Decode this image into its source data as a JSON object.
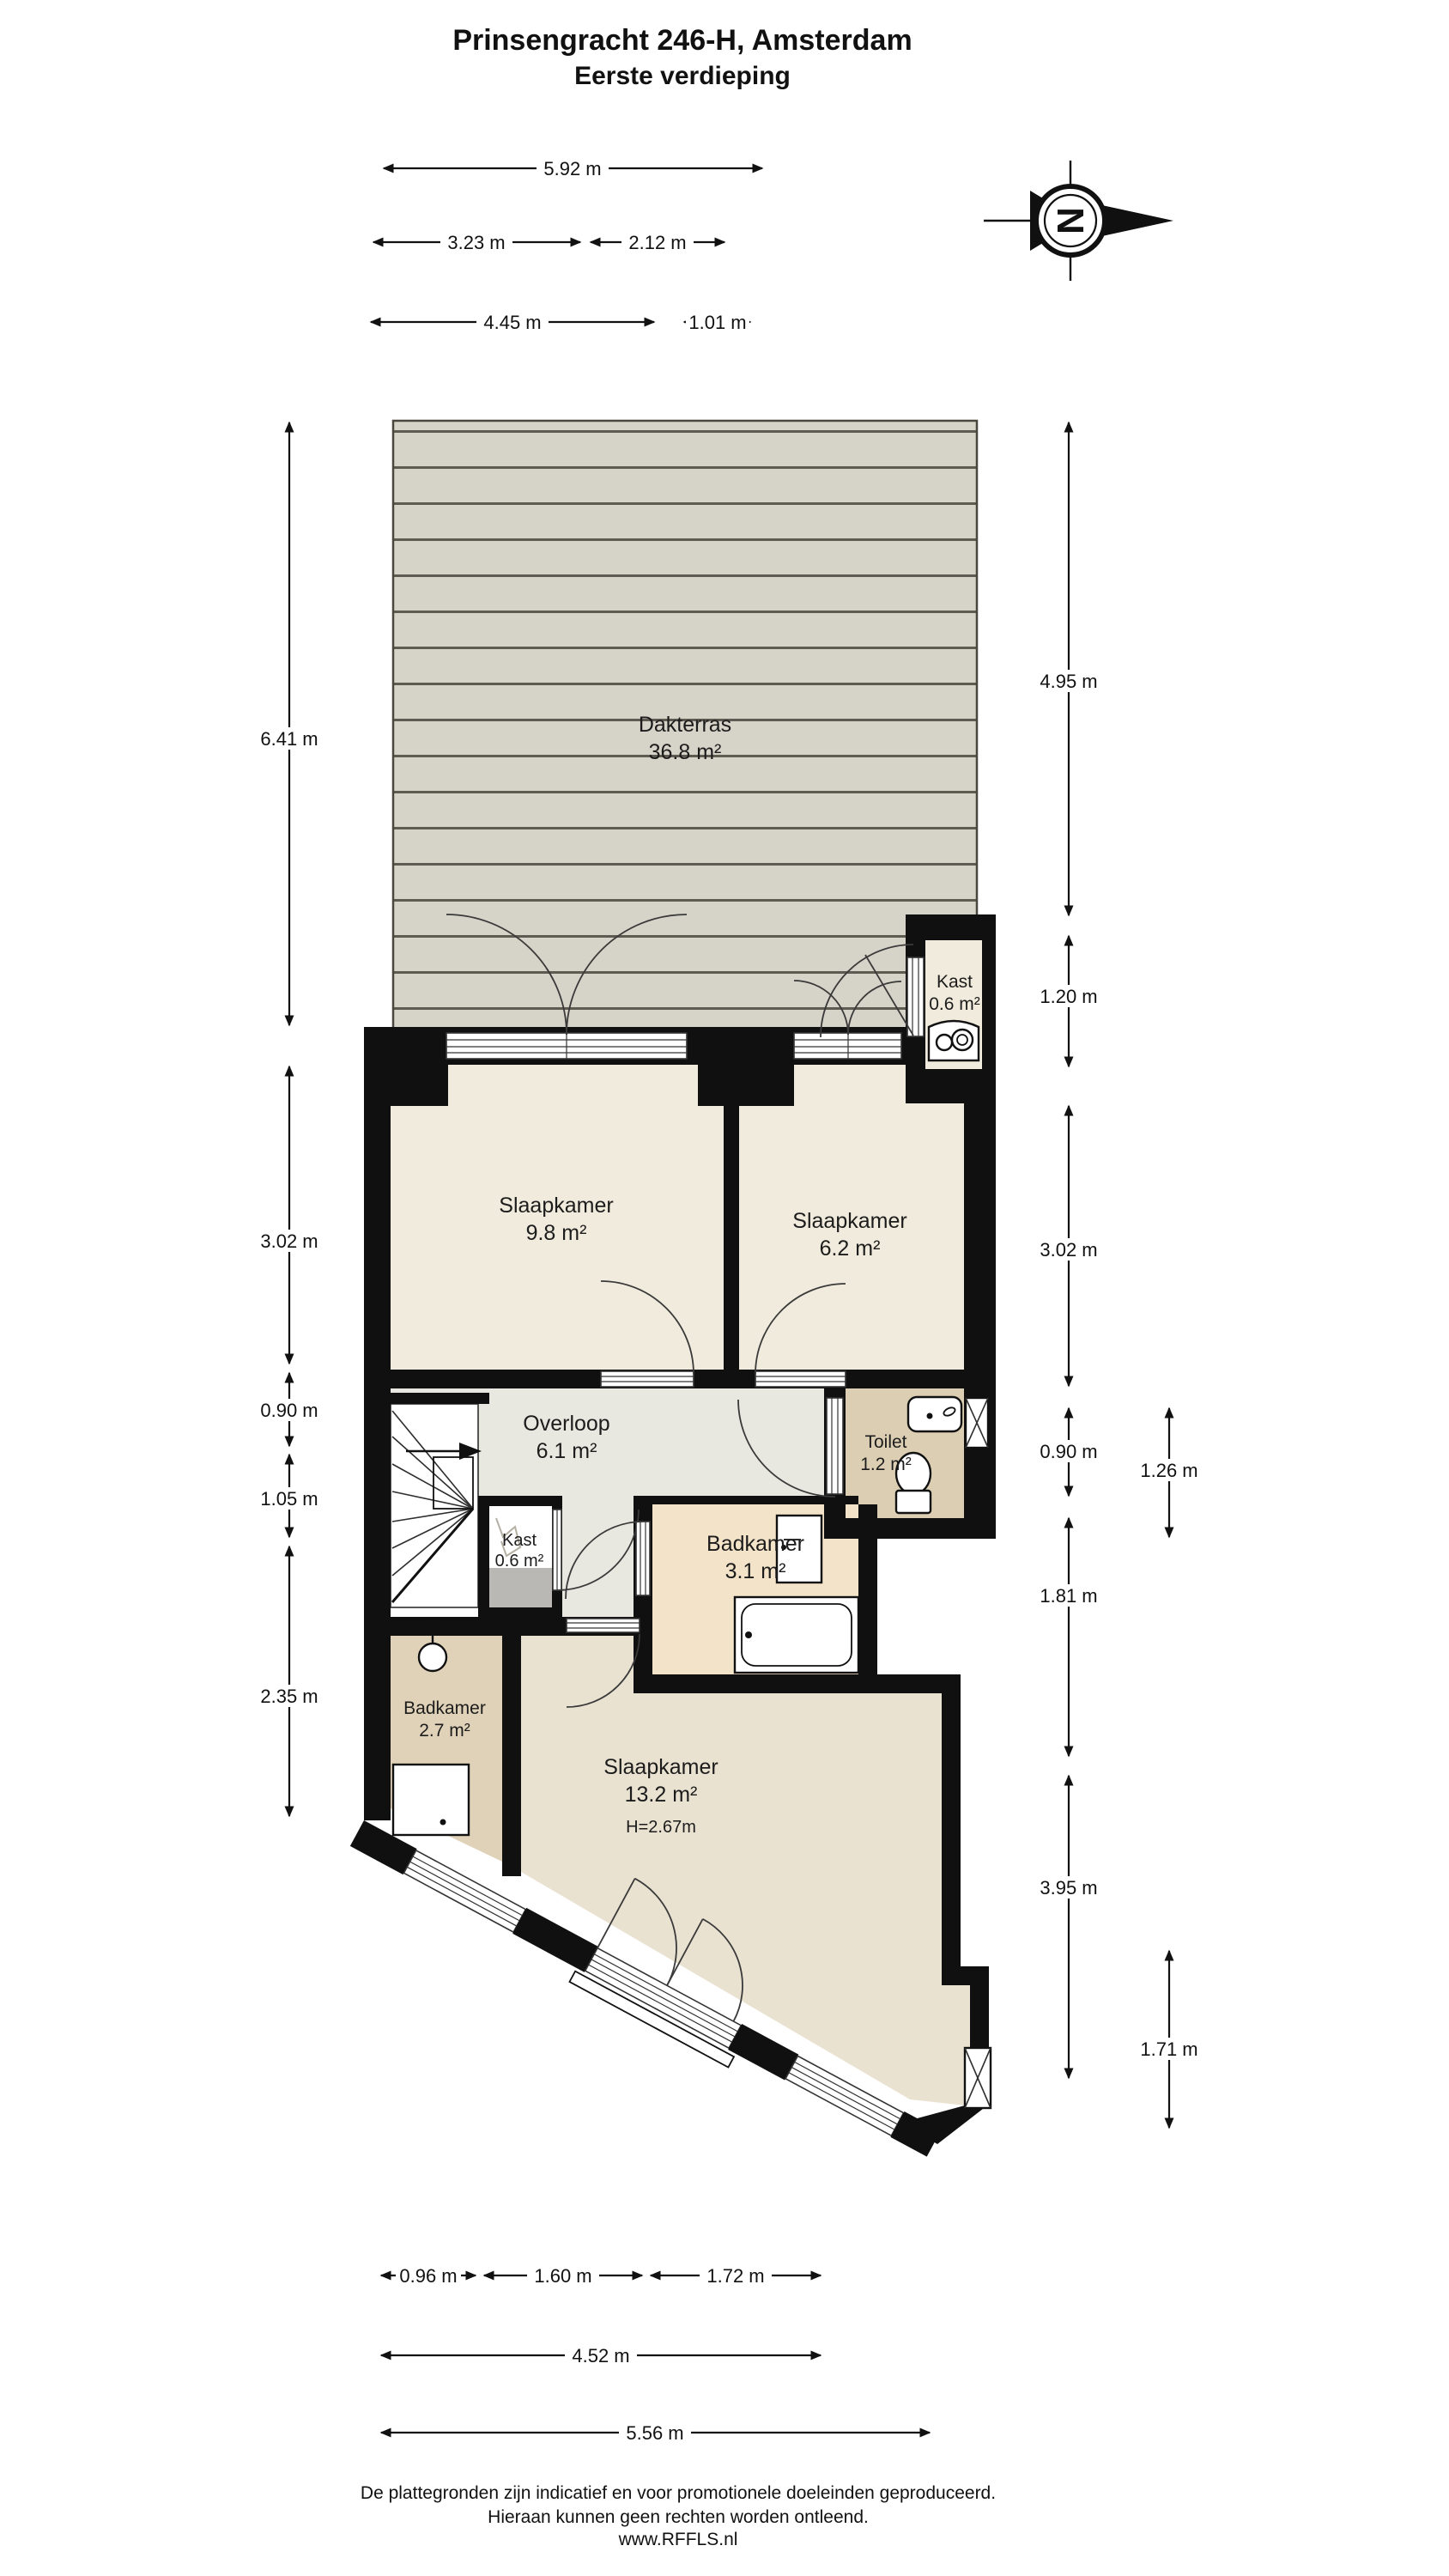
{
  "title": {
    "line1": "Prinsengracht 246-H, Amsterdam",
    "line2": "Eerste verdieping"
  },
  "compass": {
    "north_label": "N"
  },
  "rooms": [
    {
      "name": "Dakterras",
      "area": "36.8 m²"
    },
    {
      "name": "Kast",
      "area": "0.6 m²"
    },
    {
      "name": "Slaapkamer",
      "area": "9.8 m²"
    },
    {
      "name": "Slaapkamer",
      "area": "6.2 m²"
    },
    {
      "name": "Overloop",
      "area": "6.1 m²"
    },
    {
      "name": "Toilet",
      "area": "1.2 m²"
    },
    {
      "name": "Kast",
      "area": "0.6 m²"
    },
    {
      "name": "Badkamer",
      "area": "3.1 m²"
    },
    {
      "name": "Badkamer",
      "area": "2.7 m²"
    },
    {
      "name": "Slaapkamer",
      "area": "13.2 m²",
      "height": "H=2.67m"
    }
  ],
  "dimensions": {
    "top": [
      {
        "label": "5.92 m"
      },
      {
        "label": "3.23 m"
      },
      {
        "label": "2.12 m"
      },
      {
        "label": "4.45 m"
      },
      {
        "label": "1.01 m"
      }
    ],
    "left": [
      {
        "label": "6.41 m"
      },
      {
        "label": "3.02 m"
      },
      {
        "label": "0.90 m"
      },
      {
        "label": "1.05 m"
      },
      {
        "label": "2.35 m"
      }
    ],
    "right": [
      {
        "label": "4.95 m"
      },
      {
        "label": "1.20 m"
      },
      {
        "label": "3.02 m"
      },
      {
        "label": "0.90 m"
      },
      {
        "label": "1.26 m"
      },
      {
        "label": "1.81 m"
      },
      {
        "label": "3.95 m"
      },
      {
        "label": "1.71 m"
      }
    ],
    "bottom": [
      {
        "label": "0.96 m"
      },
      {
        "label": "1.60 m"
      },
      {
        "label": "1.72 m"
      },
      {
        "label": "4.52 m"
      },
      {
        "label": "5.56 m"
      }
    ]
  },
  "footer": {
    "line1": "De plattegronden zijn indicatief en voor promotionele doeleinden geproduceerd.",
    "line2": "Hieraan kunnen geen rechten worden ontleend.",
    "line3": "www.RFFLS.nl"
  },
  "colors": {
    "wall": "#101010",
    "deck_plank": "#d6d3c8",
    "deck_line": "#5e5b52",
    "room": "#f0ebdc",
    "hall": "#e9e8e0",
    "bath": "#f3e3c8",
    "toilet": "#dbceb3",
    "bath2": "#e0d2b8",
    "bedroom_large": "#eae2d1",
    "closet_gray": "#b9b8b4"
  }
}
